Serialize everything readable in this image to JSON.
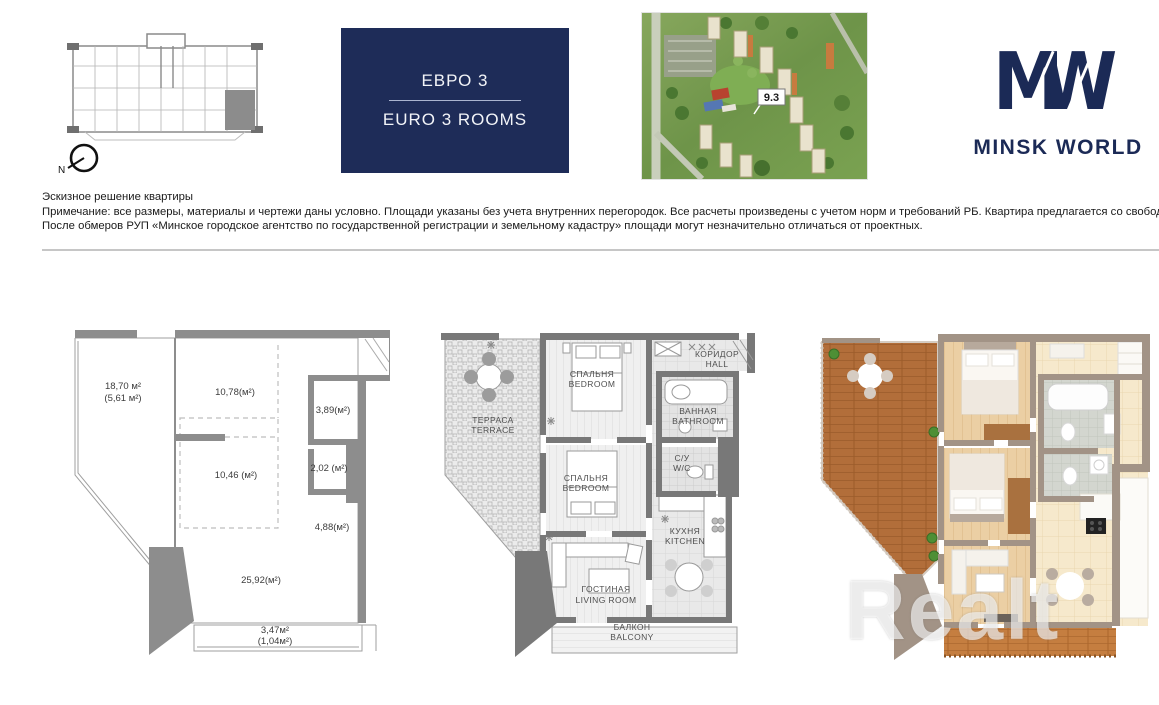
{
  "header": {
    "euro_card": {
      "title_ru": "ЕВРО 3",
      "title_en": "EURO 3 ROOMS",
      "bg": "#1e2c58"
    },
    "brand": {
      "name": "MINSK WORLD",
      "color": "#1b2a56"
    },
    "aerial": {
      "badge": "9.3"
    },
    "compass": {
      "north": "N"
    }
  },
  "notes": {
    "title": "Эскизное решение квартиры",
    "line1": "Примечание: все размеры, материалы и чертежи даны условно. Площади указаны без учета внутренних перегородок. Все расчеты произведены с учетом норм и требований РБ. Квартира предлагается со свободной планировкой.",
    "line2": "После обмеров РУП «Минское городское агентство по государственной регистрации и земельному кадастру» площади могут незначительно отличаться от проектных."
  },
  "dimension_plan": {
    "terrace_area": "18,70 м²",
    "terrace_area_reduced": "(5,61 м²)",
    "room_top": "10,78(м²)",
    "room_389": "3,89(м²)",
    "room_202": "2,02 (м²)",
    "room_mid": "10,46 (м²)",
    "room_488": "4,88(м²)",
    "room_living": "25,92(м²)",
    "balcony_area": "3,47м²",
    "balcony_area_reduced": "(1,04м²)"
  },
  "room_plan": {
    "terrace_ru": "ТЕРРАСА",
    "terrace_en": "TERRACE",
    "bedroom1_ru": "СПАЛЬНЯ",
    "bedroom1_en": "BEDROOM",
    "hall_ru": "КОРИДОР",
    "hall_en": "HALL",
    "bath_ru": "ВАННАЯ",
    "bath_en": "BATHROOM",
    "wc_ru": "С/У",
    "wc_en": "W/C",
    "bedroom2_ru": "СПАЛЬНЯ",
    "bedroom2_en": "BEDROOM",
    "kitchen_ru": "КУХНЯ",
    "kitchen_en": "KITCHEN",
    "living_ru": "ГОСТИНАЯ",
    "living_en": "LIVING ROOM",
    "balcony_ru": "БАЛКОН",
    "balcony_en": "BALCONY"
  },
  "watermark": "Realt"
}
